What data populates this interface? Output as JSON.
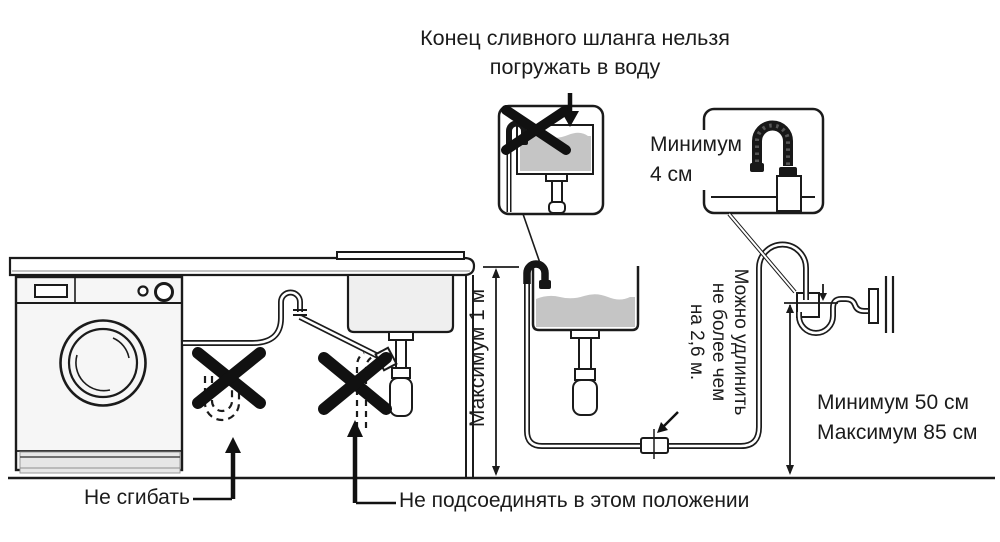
{
  "diagram": {
    "title": {
      "line1": "Конец сливного шланга нельзя",
      "line2": "погружать в воду"
    },
    "callouts": {
      "standpipe_gap": {
        "line1": "Минимум",
        "line2": "4 см"
      },
      "max_hose_height": "Максимум 1 м",
      "extension": {
        "line1": "Можно удлинить",
        "line2": "не более чем",
        "line3": "на 2,6 м."
      },
      "standpipe_height": {
        "line1": "Минимум 50 см",
        "line2": "Максимум 85 см"
      },
      "no_bend": "Не сгибать",
      "no_connect": "Не подсоединять в этом положении"
    },
    "icons": {
      "prohibition": "x-mark-icon",
      "pointer": "arrow-icon"
    },
    "colors": {
      "ink": "#1b1b1b",
      "water": "#c5c5c5",
      "basin_fill": "#efefef",
      "machine_fill": "#f6f6f6",
      "background": "#ffffff"
    }
  }
}
